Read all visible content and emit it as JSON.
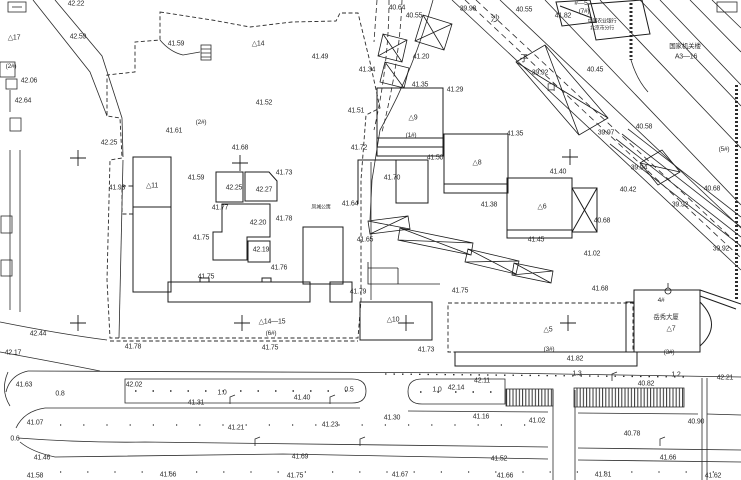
{
  "colors": {
    "ink": "#2b2b2b",
    "paper": "#ffffff"
  },
  "labels": [
    {
      "t": "42.22",
      "x": 76,
      "y": 4
    },
    {
      "t": "42.59",
      "x": 78,
      "y": 37
    },
    {
      "t": "△17",
      "x": 14,
      "y": 38,
      "c": "bld"
    },
    {
      "t": "(2#)",
      "x": 11,
      "y": 67,
      "c": "ref"
    },
    {
      "t": "42.06",
      "x": 29,
      "y": 81
    },
    {
      "t": "42.64",
      "x": 23,
      "y": 101
    },
    {
      "t": "41.59",
      "x": 176,
      "y": 44
    },
    {
      "t": "(2#)",
      "x": 201,
      "y": 123,
      "c": "ref"
    },
    {
      "t": "41.61",
      "x": 174,
      "y": 131
    },
    {
      "t": "42.25",
      "x": 109,
      "y": 143
    },
    {
      "t": "41.68",
      "x": 240,
      "y": 148
    },
    {
      "t": "△14",
      "x": 258,
      "y": 44,
      "c": "bld"
    },
    {
      "t": "41.49",
      "x": 320,
      "y": 57
    },
    {
      "t": "40.64",
      "x": 397,
      "y": 8
    },
    {
      "t": "40.55",
      "x": 414,
      "y": 16
    },
    {
      "t": "39.98",
      "x": 468,
      "y": 9
    },
    {
      "t": "41.20",
      "x": 421,
      "y": 57
    },
    {
      "t": "41.34",
      "x": 367,
      "y": 70
    },
    {
      "t": "41.52",
      "x": 264,
      "y": 103
    },
    {
      "t": "41.35",
      "x": 420,
      "y": 85
    },
    {
      "t": "41.29",
      "x": 455,
      "y": 90
    },
    {
      "t": "41.51",
      "x": 356,
      "y": 111
    },
    {
      "t": "△9",
      "x": 413,
      "y": 118,
      "c": "bld"
    },
    {
      "t": "(1#)",
      "x": 411,
      "y": 136,
      "c": "ref"
    },
    {
      "t": "41.72",
      "x": 359,
      "y": 148
    },
    {
      "t": "41.50",
      "x": 435,
      "y": 158
    },
    {
      "t": "40.55",
      "x": 524,
      "y": 10
    },
    {
      "t": "41.82",
      "x": 563,
      "y": 16
    },
    {
      "t": "#—5",
      "x": 581,
      "y": 4,
      "c": "ref"
    },
    {
      "t": "(7#)",
      "x": 584,
      "y": 12,
      "c": "ref"
    },
    {
      "t": "中国农业银行",
      "x": 602,
      "y": 22,
      "c": "cnsm"
    },
    {
      "t": "北京市分行",
      "x": 602,
      "y": 29,
      "c": "cnsm"
    },
    {
      "t": "国家机关楼",
      "x": 685,
      "y": 47,
      "c": "cn"
    },
    {
      "t": "A3—16",
      "x": 686,
      "y": 57
    },
    {
      "t": "沙",
      "x": 495,
      "y": 19,
      "c": "st"
    },
    {
      "t": "子",
      "x": 524,
      "y": 59,
      "c": "st"
    },
    {
      "t": "口",
      "x": 551,
      "y": 88,
      "c": "st"
    },
    {
      "t": "39.92",
      "x": 540,
      "y": 73
    },
    {
      "t": "40.45",
      "x": 595,
      "y": 70
    },
    {
      "t": "41.35",
      "x": 515,
      "y": 134
    },
    {
      "t": "39.97",
      "x": 606,
      "y": 133
    },
    {
      "t": "40.58",
      "x": 644,
      "y": 127
    },
    {
      "t": "(5#)",
      "x": 724,
      "y": 150,
      "c": "ref"
    },
    {
      "t": "41.59",
      "x": 196,
      "y": 178
    },
    {
      "t": "42.25",
      "x": 234,
      "y": 188
    },
    {
      "t": "42.27",
      "x": 264,
      "y": 190
    },
    {
      "t": "41.73",
      "x": 284,
      "y": 173
    },
    {
      "t": "△11",
      "x": 152,
      "y": 186,
      "c": "bld"
    },
    {
      "t": "41.77",
      "x": 220,
      "y": 208
    },
    {
      "t": "42.20",
      "x": 258,
      "y": 223
    },
    {
      "t": "41.78",
      "x": 284,
      "y": 219
    },
    {
      "t": "41.75",
      "x": 201,
      "y": 238
    },
    {
      "t": "42.19",
      "x": 261,
      "y": 250
    },
    {
      "t": "41.76",
      "x": 279,
      "y": 268
    },
    {
      "t": "41.75",
      "x": 206,
      "y": 277
    },
    {
      "t": "凤城公寓",
      "x": 321,
      "y": 208,
      "c": "cnsm"
    },
    {
      "t": "41.64",
      "x": 350,
      "y": 204
    },
    {
      "t": "41.65",
      "x": 365,
      "y": 240
    },
    {
      "t": "41.93",
      "x": 117,
      "y": 188
    },
    {
      "t": "41.70",
      "x": 392,
      "y": 178
    },
    {
      "t": "△8",
      "x": 477,
      "y": 163,
      "c": "bld"
    },
    {
      "t": "41.40",
      "x": 558,
      "y": 172
    },
    {
      "t": "41.38",
      "x": 489,
      "y": 205
    },
    {
      "t": "△6",
      "x": 542,
      "y": 207,
      "c": "bld"
    },
    {
      "t": "40.68",
      "x": 602,
      "y": 221
    },
    {
      "t": "41.45",
      "x": 536,
      "y": 240
    },
    {
      "t": "41.02",
      "x": 592,
      "y": 254
    },
    {
      "t": "39.94",
      "x": 639,
      "y": 168
    },
    {
      "t": "40.42",
      "x": 628,
      "y": 190
    },
    {
      "t": "39.92",
      "x": 680,
      "y": 205
    },
    {
      "t": "40.68",
      "x": 712,
      "y": 189
    },
    {
      "t": "39.92",
      "x": 721,
      "y": 249
    },
    {
      "t": "41.79",
      "x": 358,
      "y": 292
    },
    {
      "t": "△14—15",
      "x": 272,
      "y": 322,
      "c": "bld"
    },
    {
      "t": "(6#)",
      "x": 271,
      "y": 334,
      "c": "ref"
    },
    {
      "t": "41.75",
      "x": 270,
      "y": 348
    },
    {
      "t": "41.78",
      "x": 133,
      "y": 347
    },
    {
      "t": "42.44",
      "x": 38,
      "y": 334
    },
    {
      "t": "42.17",
      "x": 13,
      "y": 353
    },
    {
      "t": "41.75",
      "x": 460,
      "y": 291
    },
    {
      "t": "41.68",
      "x": 600,
      "y": 289
    },
    {
      "t": "△10",
      "x": 393,
      "y": 320,
      "c": "bld"
    },
    {
      "t": "△5",
      "x": 548,
      "y": 330,
      "c": "bld"
    },
    {
      "t": "41.73",
      "x": 426,
      "y": 350
    },
    {
      "t": "(3#)",
      "x": 549,
      "y": 350,
      "c": "ref"
    },
    {
      "t": "41.82",
      "x": 575,
      "y": 359
    },
    {
      "t": "4#",
      "x": 661,
      "y": 301,
      "c": "ref"
    },
    {
      "t": "岳秀大厦",
      "x": 666,
      "y": 318,
      "c": "cn"
    },
    {
      "t": "△7",
      "x": 671,
      "y": 329,
      "c": "bld"
    },
    {
      "t": "(3#)",
      "x": 669,
      "y": 353,
      "c": "ref"
    },
    {
      "t": "42.21",
      "x": 725,
      "y": 378
    },
    {
      "t": "1.2",
      "x": 676,
      "y": 375,
      "c": "dim"
    },
    {
      "t": "1.3",
      "x": 577,
      "y": 374,
      "c": "dim"
    },
    {
      "t": "40.82",
      "x": 646,
      "y": 384
    },
    {
      "t": "42.11",
      "x": 482,
      "y": 381
    },
    {
      "t": "42.14",
      "x": 456,
      "y": 388
    },
    {
      "t": "1.0",
      "x": 437,
      "y": 390,
      "c": "dim"
    },
    {
      "t": "0.5",
      "x": 349,
      "y": 390,
      "c": "dim"
    },
    {
      "t": "41.40",
      "x": 302,
      "y": 398
    },
    {
      "t": "42.02",
      "x": 134,
      "y": 385
    },
    {
      "t": "1.0",
      "x": 222,
      "y": 393,
      "c": "dim"
    },
    {
      "t": "0.8",
      "x": 60,
      "y": 394,
      "c": "dim"
    },
    {
      "t": "41.63",
      "x": 24,
      "y": 385
    },
    {
      "t": "41.31",
      "x": 196,
      "y": 403
    },
    {
      "t": "41.30",
      "x": 392,
      "y": 418
    },
    {
      "t": "41.16",
      "x": 481,
      "y": 417
    },
    {
      "t": "41.23",
      "x": 330,
      "y": 425
    },
    {
      "t": "41.21",
      "x": 236,
      "y": 428
    },
    {
      "t": "41.07",
      "x": 35,
      "y": 423
    },
    {
      "t": "0.6",
      "x": 15,
      "y": 439,
      "c": "dim"
    },
    {
      "t": "41.46",
      "x": 42,
      "y": 458
    },
    {
      "t": "41.69",
      "x": 300,
      "y": 457
    },
    {
      "t": "41.52",
      "x": 499,
      "y": 459
    },
    {
      "t": "41.66",
      "x": 668,
      "y": 458
    },
    {
      "t": "41.02",
      "x": 537,
      "y": 421
    },
    {
      "t": "40.90",
      "x": 696,
      "y": 422
    },
    {
      "t": "40.78",
      "x": 632,
      "y": 434
    },
    {
      "t": "41.58",
      "x": 35,
      "y": 476
    },
    {
      "t": "41.66",
      "x": 168,
      "y": 475
    },
    {
      "t": "41.75",
      "x": 295,
      "y": 476
    },
    {
      "t": "41.67",
      "x": 400,
      "y": 475
    },
    {
      "t": "41.66",
      "x": 505,
      "y": 476
    },
    {
      "t": "41.81",
      "x": 603,
      "y": 475
    },
    {
      "t": "41.62",
      "x": 713,
      "y": 476
    }
  ],
  "crosses": [
    [
      78,
      158
    ],
    [
      240,
      163
    ],
    [
      570,
      157
    ],
    [
      78,
      323
    ],
    [
      242,
      323
    ],
    [
      406,
      323
    ],
    [
      568,
      323
    ]
  ]
}
